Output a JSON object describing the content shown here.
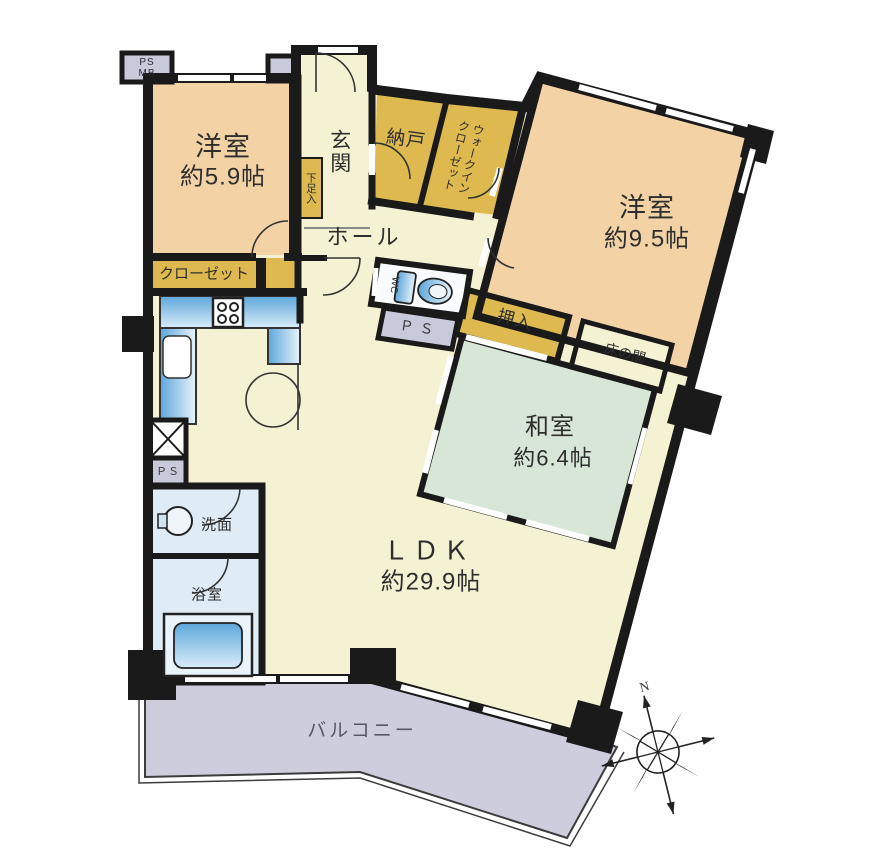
{
  "floorplan": {
    "rooms": {
      "western_room_1": {
        "label": "洋室",
        "size": "約5.9帖"
      },
      "western_room_2": {
        "label": "洋室",
        "size": "約9.5帖"
      },
      "japanese_room": {
        "label": "和室",
        "size": "約6.4帖"
      },
      "ldk": {
        "label": "ＬＤＫ",
        "size": "約29.9帖"
      },
      "entrance": {
        "label": "玄関"
      },
      "storage": {
        "label": "納戸"
      },
      "walk_in_closet": {
        "label": "ウォークイン\nクローゼット"
      },
      "hall": {
        "label": "ホール"
      },
      "closet": {
        "label": "クローゼット"
      },
      "shoe_cabinet": {
        "label": "下足入"
      },
      "oshiire": {
        "label": "押入"
      },
      "tokonoma": {
        "label": "床の間"
      },
      "washroom": {
        "label": "洗面"
      },
      "bathroom": {
        "label": "浴室"
      },
      "toilet": {
        "label": "WC"
      },
      "balcony": {
        "label": "バルコニー"
      }
    },
    "utility": {
      "meter_box": {
        "label": "PS\nMB"
      },
      "pipe_space_toilet": {
        "label": "Ｐ Ｓ"
      },
      "pipe_space_left": {
        "label": "ＰＳ"
      }
    },
    "compass": {
      "north_label": "N"
    },
    "colors": {
      "wall": "#1a1a1a",
      "western_room": "#f3d3a6",
      "yellow_storage": "#ddb94f",
      "cream_floor": "#f5f2d3",
      "tatami_green": "#d7e6d6",
      "balcony_lavender": "#cdcdde",
      "pipe_space_lavender": "#c9c9dc",
      "wet_area_blue": "#dfecf5",
      "fixture_blue": "#5da6da",
      "toilet_room_white": "#fafbfc"
    }
  }
}
